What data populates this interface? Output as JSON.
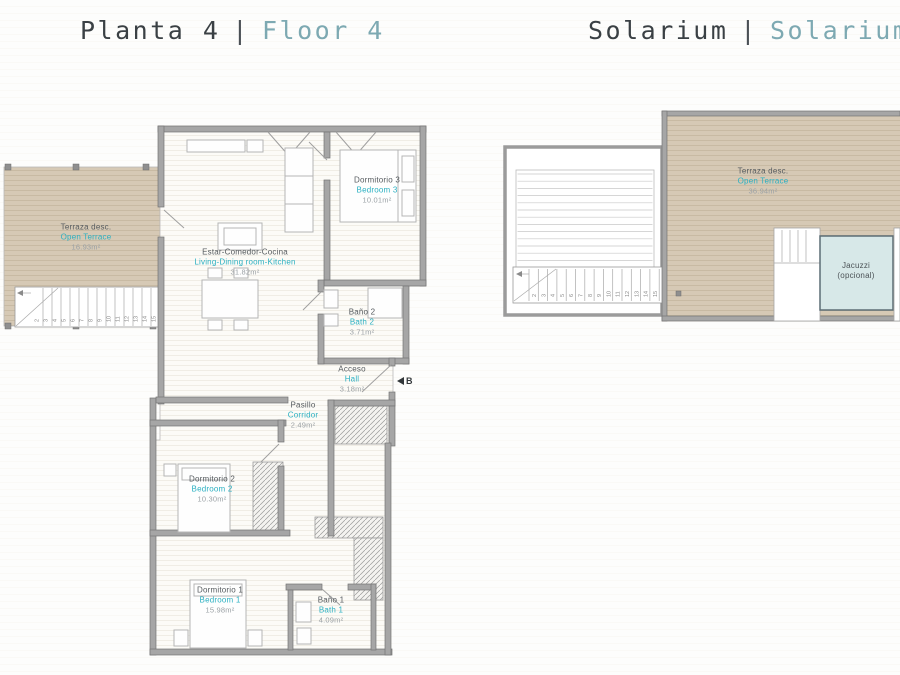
{
  "titles": {
    "floor4": {
      "primary": "Planta 4",
      "separator": "|",
      "secondary": "Floor 4"
    },
    "solarium": {
      "primary": "Solarium",
      "separator": "|",
      "secondary": "Solarium"
    }
  },
  "colors": {
    "accent_teal": "#2bb0c2",
    "muted_teal": "#7da9b2",
    "wall_gray": "#a6a6a6",
    "terrace_beige": "#d6c9b5",
    "jacuzzi_fill": "#d7e8e8"
  },
  "floor4": {
    "rooms": {
      "terrace": {
        "es": "Terraza desc.",
        "en": "Open Terrace",
        "area": "16.93m²"
      },
      "living": {
        "es": "Estar-Comedor-Cocina",
        "en": "Living-Dining room-Kitchen",
        "area": "31.82m²"
      },
      "bedroom3": {
        "es": "Dormitorio 3",
        "en": "Bedroom 3",
        "area": "10.01m²"
      },
      "bath2": {
        "es": "Baño 2",
        "en": "Bath 2",
        "area": "3.71m²"
      },
      "hall": {
        "es": "Acceso",
        "en": "Hall",
        "area": "3.18m²"
      },
      "corridor": {
        "es": "Pasillo",
        "en": "Corridor",
        "area": "2.49m²"
      },
      "bedroom2": {
        "es": "Dormitorio 2",
        "en": "Bedroom 2",
        "area": "10.30m²"
      },
      "bedroom1": {
        "es": "Dormitorio 1",
        "en": "Bedroom 1",
        "area": "15.98m²"
      },
      "bath1": {
        "es": "Baño 1",
        "en": "Bath 1",
        "area": "4.09m²"
      }
    },
    "entrance_label": "B"
  },
  "solarium": {
    "rooms": {
      "terrace": {
        "es": "Terraza desc.",
        "en": "Open Terrace",
        "area": "36.94m²"
      },
      "jacuzzi": {
        "line1": "Jacuzzi",
        "line2": "(opcional)"
      }
    }
  },
  "stairs": {
    "steps": [
      "2",
      "3",
      "4",
      "5",
      "6",
      "7",
      "8",
      "9",
      "10",
      "11",
      "12",
      "13",
      "14",
      "15",
      "16"
    ]
  }
}
